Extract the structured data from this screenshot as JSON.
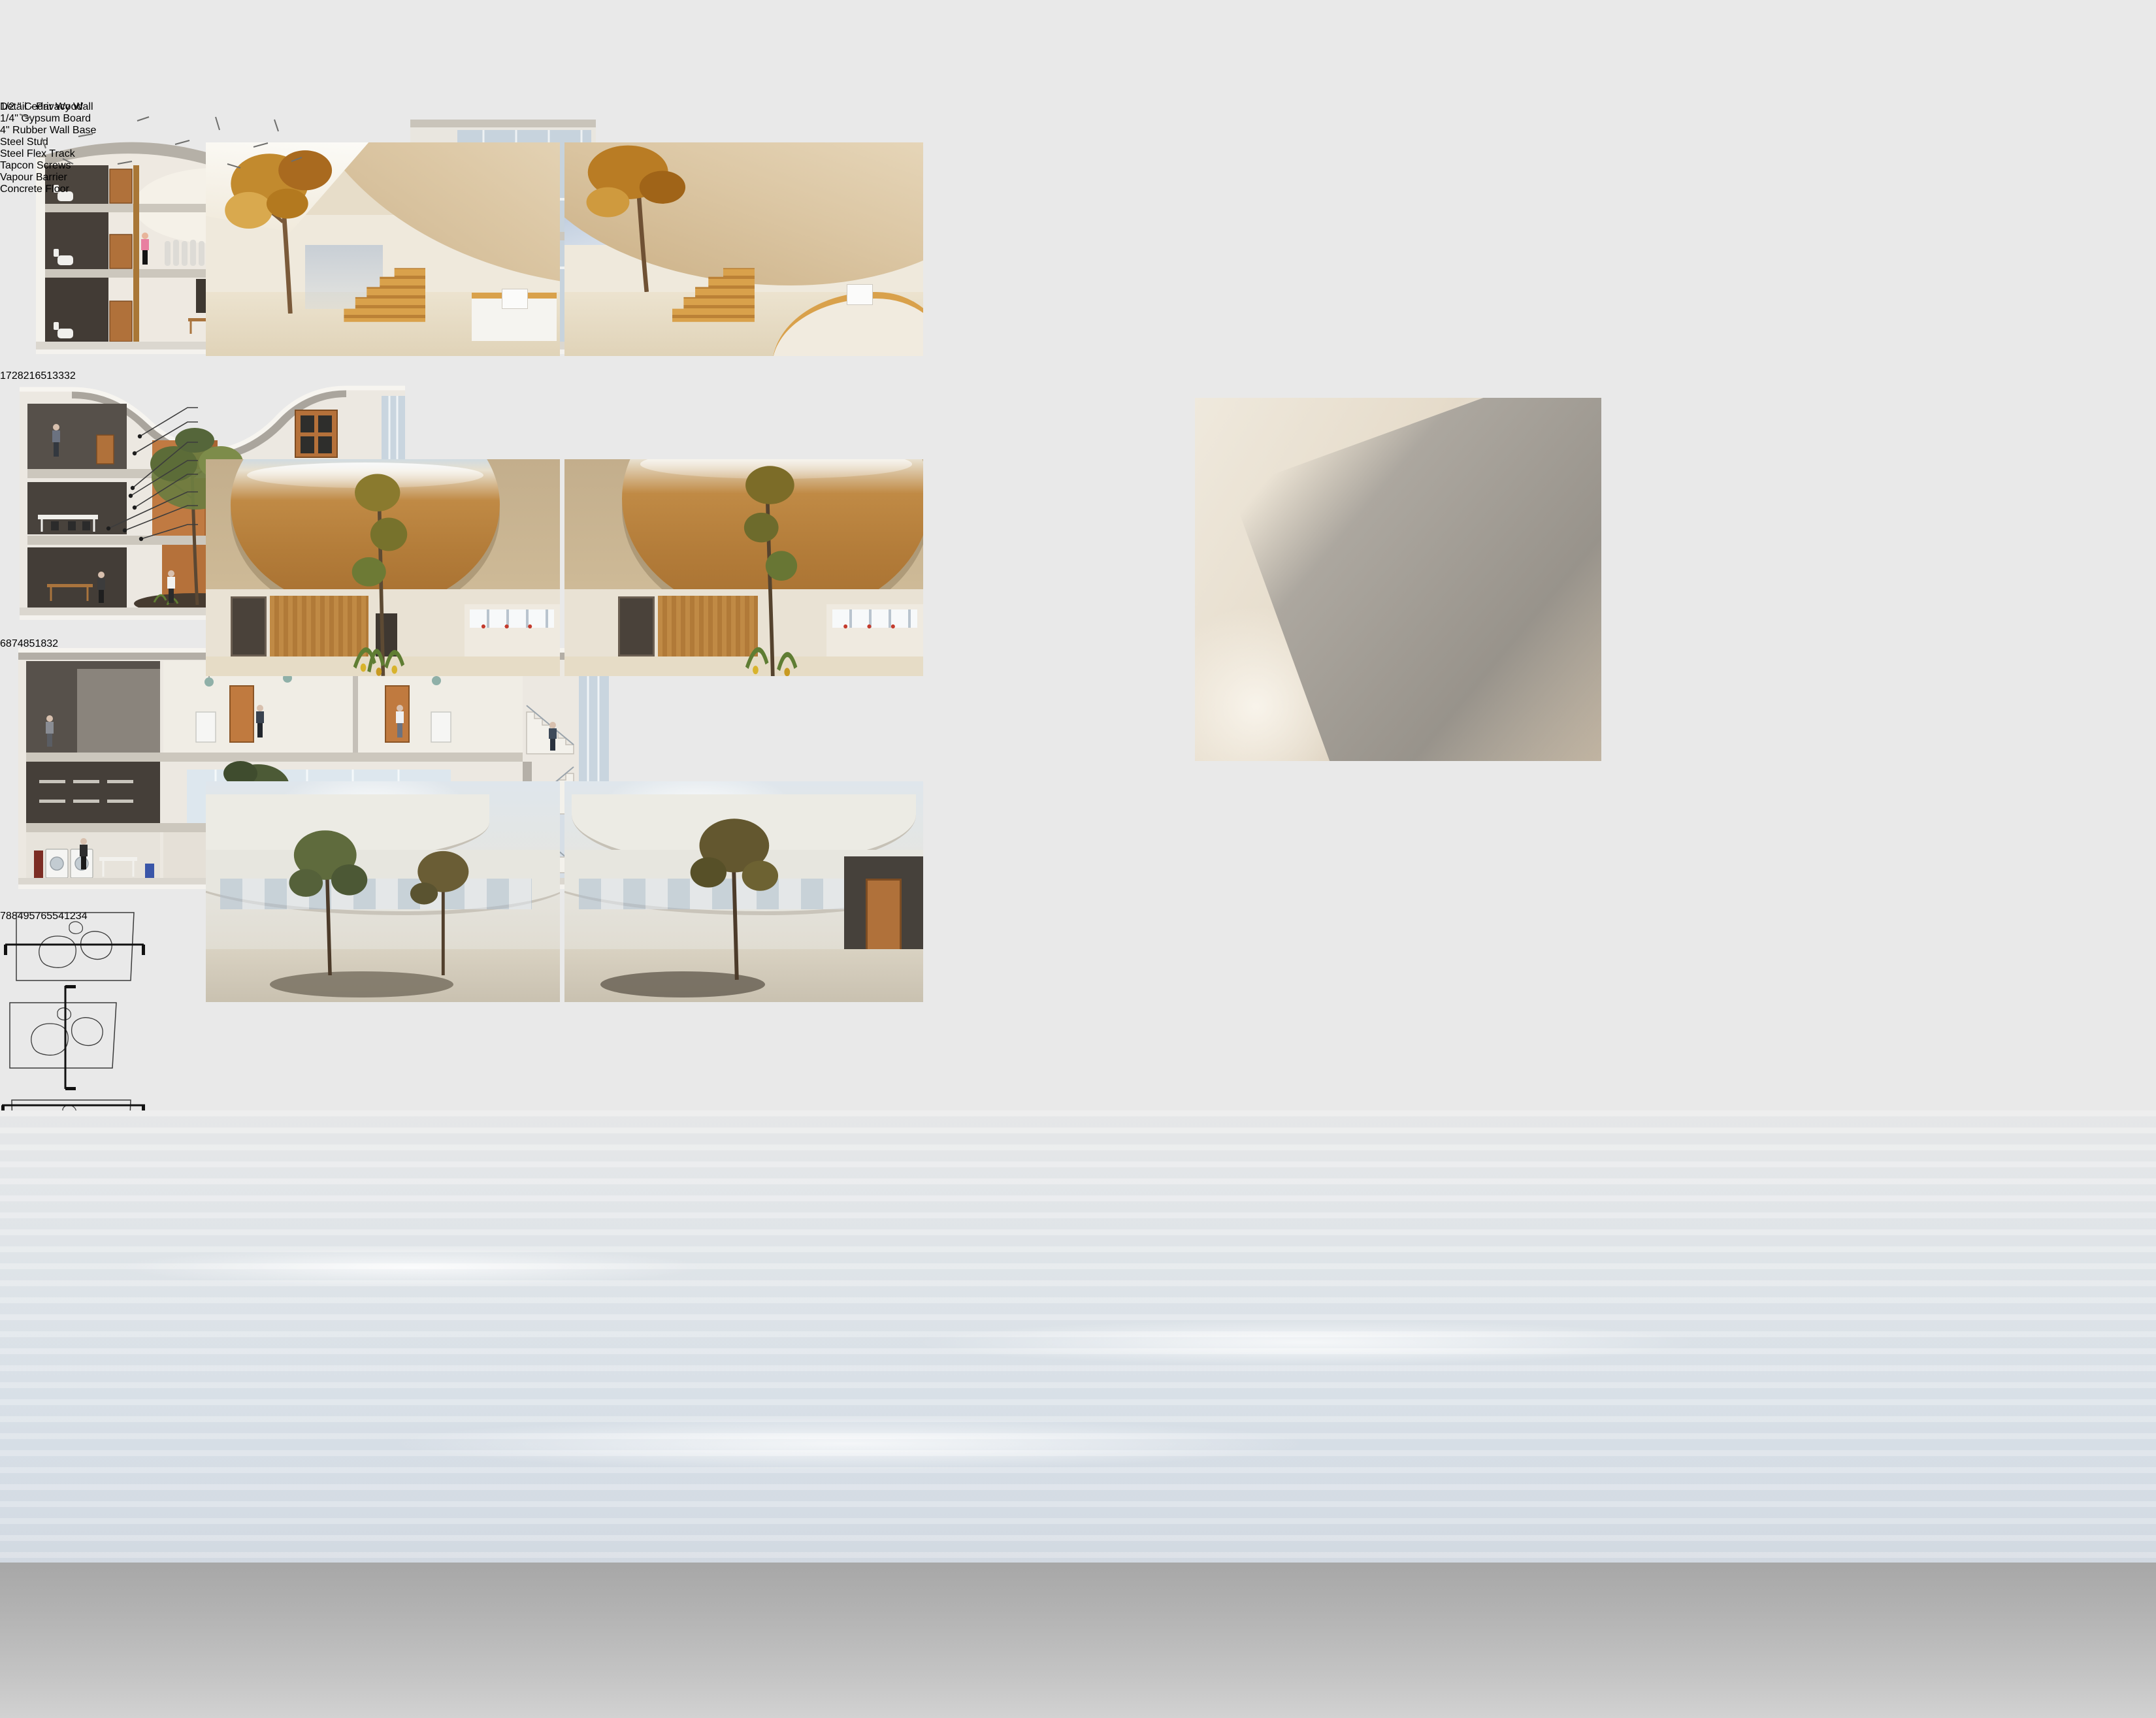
{
  "detail": {
    "title": "Detail - Privacy Wall",
    "callouts": [
      "1/2 \" Cedar Wood",
      "1/4\" Gypsum Board",
      "4\" Rubber Wall Base",
      "Steel Stud",
      "Steel Flex Track",
      "Tapcon Screws",
      "Vapour Barrier",
      "Concrete Floor"
    ]
  },
  "legends": [
    {
      "title": "Legend",
      "columns": [
        [
          "1. W/C",
          "2. Lounge",
          "3. Developing Area",
          "4. Foyer"
        ],
        [
          "5. Reception",
          "6. Storage",
          "7. Meeting Room",
          "8. Kitchen"
        ]
      ]
    },
    {
      "title": "Legend",
      "columns": [
        [
          "1. Textile Studio",
          "2. Lounge",
          "3. Developing Area",
          "4. Workshops"
        ],
        [
          "5. Storage",
          "6. Office",
          "7. Meeting Room",
          "8. W/C"
        ]
      ]
    },
    {
      "title": "Legend",
      "columns": [
        [
          "1. Laundry",
          "2. Textile Studio",
          "3. Plastic Shop",
          "4. Emergency Stairs",
          "5. Workshops"
        ],
        [
          "6. Reception",
          "7. Storage",
          "8. Office",
          "9. Lounge"
        ]
      ]
    }
  ],
  "sections": [
    {
      "name": "section-cut-1",
      "labels": [
        {
          "n": "1",
          "x": 4.5,
          "y": 22
        },
        {
          "n": "7",
          "x": 43,
          "y": 27
        },
        {
          "n": "2",
          "x": 63,
          "y": 30
        },
        {
          "n": "8",
          "x": 85,
          "y": 24
        },
        {
          "n": "2",
          "x": 96,
          "y": 30
        },
        {
          "n": "1",
          "x": 4.5,
          "y": 61
        },
        {
          "n": "6",
          "x": 36,
          "y": 53
        },
        {
          "n": "5",
          "x": 53,
          "y": 58
        },
        {
          "n": "1",
          "x": 4.5,
          "y": 87
        },
        {
          "n": "3",
          "x": 30,
          "y": 84
        },
        {
          "n": "3",
          "x": 45,
          "y": 86
        },
        {
          "n": "3",
          "x": 60,
          "y": 90
        },
        {
          "n": "2",
          "x": 88,
          "y": 89
        }
      ]
    },
    {
      "name": "section-cut-2",
      "labels": [
        {
          "n": "6",
          "x": 8.6,
          "y": 20
        },
        {
          "n": "8",
          "x": 55.5,
          "y": 26
        },
        {
          "n": "7",
          "x": 80,
          "y": 30
        },
        {
          "n": "4",
          "x": 8.6,
          "y": 51
        },
        {
          "n": "8",
          "x": 55.5,
          "y": 53
        },
        {
          "n": "5",
          "x": 77.5,
          "y": 57
        },
        {
          "n": "1",
          "x": 8.6,
          "y": 76
        },
        {
          "n": "8",
          "x": 55.5,
          "y": 73
        },
        {
          "n": "3",
          "x": 80,
          "y": 76
        },
        {
          "n": "2",
          "x": 46,
          "y": 90
        }
      ]
    },
    {
      "name": "section-cut-3",
      "labels": [
        {
          "n": "7",
          "x": 14,
          "y": 23
        },
        {
          "n": "8",
          "x": 47,
          "y": 23
        },
        {
          "n": "8",
          "x": 68,
          "y": 23
        },
        {
          "n": "4",
          "x": 83,
          "y": 23
        },
        {
          "n": "9",
          "x": 97,
          "y": 23
        },
        {
          "n": "5",
          "x": 14,
          "y": 48
        },
        {
          "n": "7",
          "x": 41,
          "y": 51
        },
        {
          "n": "6",
          "x": 53,
          "y": 52
        },
        {
          "n": "5",
          "x": 40,
          "y": 59
        },
        {
          "n": "5",
          "x": 71,
          "y": 52
        },
        {
          "n": "4",
          "x": 83,
          "y": 52
        },
        {
          "n": "1",
          "x": 14,
          "y": 79
        },
        {
          "n": "2",
          "x": 38.5,
          "y": 79
        },
        {
          "n": "3",
          "x": 61,
          "y": 79
        },
        {
          "n": "4",
          "x": 88,
          "y": 73
        }
      ]
    }
  ],
  "colors": {
    "wood_accent": "#b0713a",
    "cedar": "#d9ae7d",
    "steel_core": "#ccd3d6",
    "concrete_floor": "#a6a6a4",
    "tapcon_blue": "#3a72a8",
    "callout_line": "#121212"
  }
}
